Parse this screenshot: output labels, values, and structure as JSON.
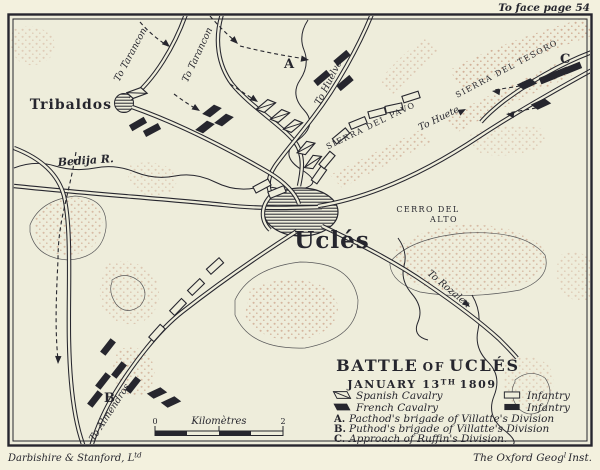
{
  "frame": {
    "top_note_text": "To face page 54",
    "credit_left_main": "Darbishire & Stanford, L",
    "credit_left_sup": "td",
    "credit_right_main": "The Oxford Geog",
    "credit_right_sup": "l",
    "credit_right_tail": "Inst."
  },
  "title": {
    "line1_a": "BATTLE",
    "line1_b": "OF",
    "line1_c": "UCLÉS",
    "date_main": "JANUARY 13",
    "date_sup": "TH",
    "date_tail": "1809"
  },
  "legend": {
    "entries": [
      {
        "symbol": "spanish-cavalry",
        "label": "Spanish Cavalry"
      },
      {
        "symbol": "french-cavalry",
        "label": "French Cavalry"
      },
      {
        "symbol": "spanish-infantry",
        "label": "Infantry"
      },
      {
        "symbol": "french-infantry",
        "label": "Infantry"
      }
    ],
    "notes": [
      {
        "key": "A.",
        "text": "Pacthod's brigade of Villatte's Division"
      },
      {
        "key": "B.",
        "text": "Puthod's brigade of Villatte's Division"
      },
      {
        "key": "C.",
        "text": "Approach of Ruffin's Division."
      }
    ]
  },
  "map": {
    "towns": {
      "tribaldos": "Tribaldos",
      "ucles": "Uclés"
    },
    "river": "Bedija R.",
    "roads": {
      "tarancon_w": "To Tarancon",
      "tarancon_e": "To Tarancon",
      "huelves": "To Huelves",
      "huete": "To Huete",
      "rozalen": "To Rozalen",
      "almendros": "To Almendros"
    },
    "terrain": {
      "sierra_pavo": "SIERRA DEL PAVO",
      "sierra_tesoro": "SIERRA DEL TESORO",
      "cerro_line1": "CERRO DEL",
      "cerro_line2": "ALTO"
    },
    "unit_labels": {
      "a": "A",
      "b": "B",
      "c": "C"
    },
    "scale": {
      "title": "Kilomètres",
      "ticks": [
        "0",
        "1",
        "2"
      ]
    }
  },
  "colors": {
    "paper": "#f3f1de",
    "map_bg": "#eeeddb",
    "ink": "#26262e",
    "hill": "#bb7f63"
  }
}
